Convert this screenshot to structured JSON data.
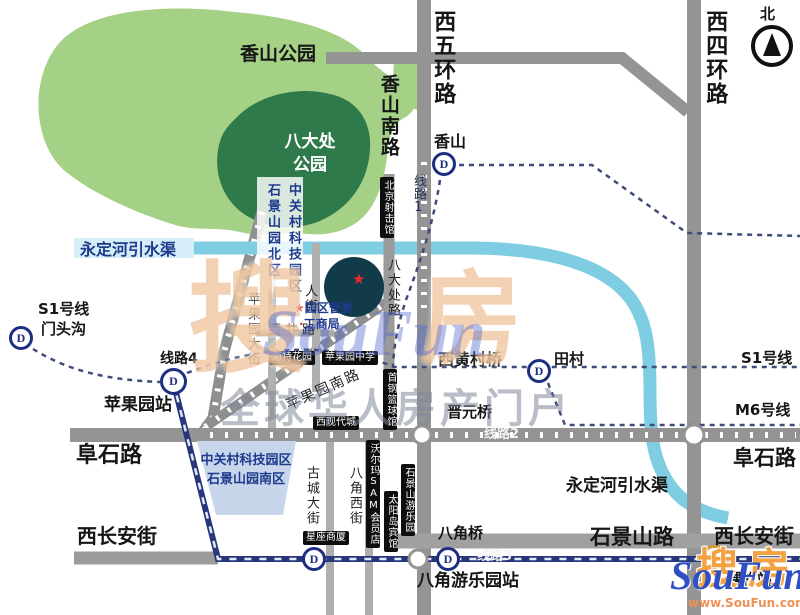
{
  "compass": {
    "north_label": "北"
  },
  "parks": {
    "xiangshan": "香山公园",
    "badachu": "八大处\n公园"
  },
  "roads": {
    "xiwuhuan": "西五环路",
    "xisihuan": "西四环路",
    "xiangshan_south": "香山南路",
    "badachu_road": "八大处路",
    "pingguoyuan_street": "苹果园大街",
    "renjie": "人街",
    "xijing": "西井路",
    "pingguoyuan_south": "苹果园南路",
    "gucheng_street": "古城大街",
    "bajiao_west": "八角西街",
    "fushi": "阜石路",
    "shijingshan_road": "石景山路",
    "chang_an_west": "西长安街"
  },
  "canal": {
    "name": "永定河引水渠"
  },
  "transit": {
    "line1": "线路1",
    "line2": "线路2",
    "line3": "线路3",
    "line4": "线路4",
    "s1_line": "S1号线",
    "mentougou": "门头沟",
    "m6_line": "M6号线",
    "metro_glyph": "D",
    "stations": {
      "xiangshan": "香山",
      "pingguoyuan": "苹果园站",
      "tiancun": "田村",
      "bajiao_amusement": "八角游乐园站",
      "wukesong": "五棵松站"
    }
  },
  "bridges": {
    "xihuangcun": "西黄村桥",
    "jinyuan": "晋元桥",
    "bajiao": "八角桥"
  },
  "zones": {
    "tech_park": "中关村科技园区",
    "north_area": "石景山园北区",
    "south_area": "石景山园南区"
  },
  "pois": {
    "shooting_range": "北京射击馆",
    "haite_garden": "海特花园",
    "pingguoyuan_school": "苹果园中学",
    "xixiandai_city": "西现代城",
    "walmart": "沃尔玛SAM会员店",
    "sun_island_hotel": "太阳岛宾馆",
    "amusement_park": "石景山游乐园",
    "shougang_gym": "首钢篮球馆",
    "xingzuo_mall": "星座商厦",
    "committee": "园区管委",
    "bureau": "工商局",
    "star": "★",
    "dot": "·"
  },
  "watermark": {
    "sou": "搜",
    "fang": "房",
    "soufun": "SouFun",
    "slogan": "全球华人房产门户"
  },
  "logo": {
    "sou": "搜",
    "fang": "房",
    "soufun": "SouFun",
    "url": "www.SouFun.com"
  }
}
